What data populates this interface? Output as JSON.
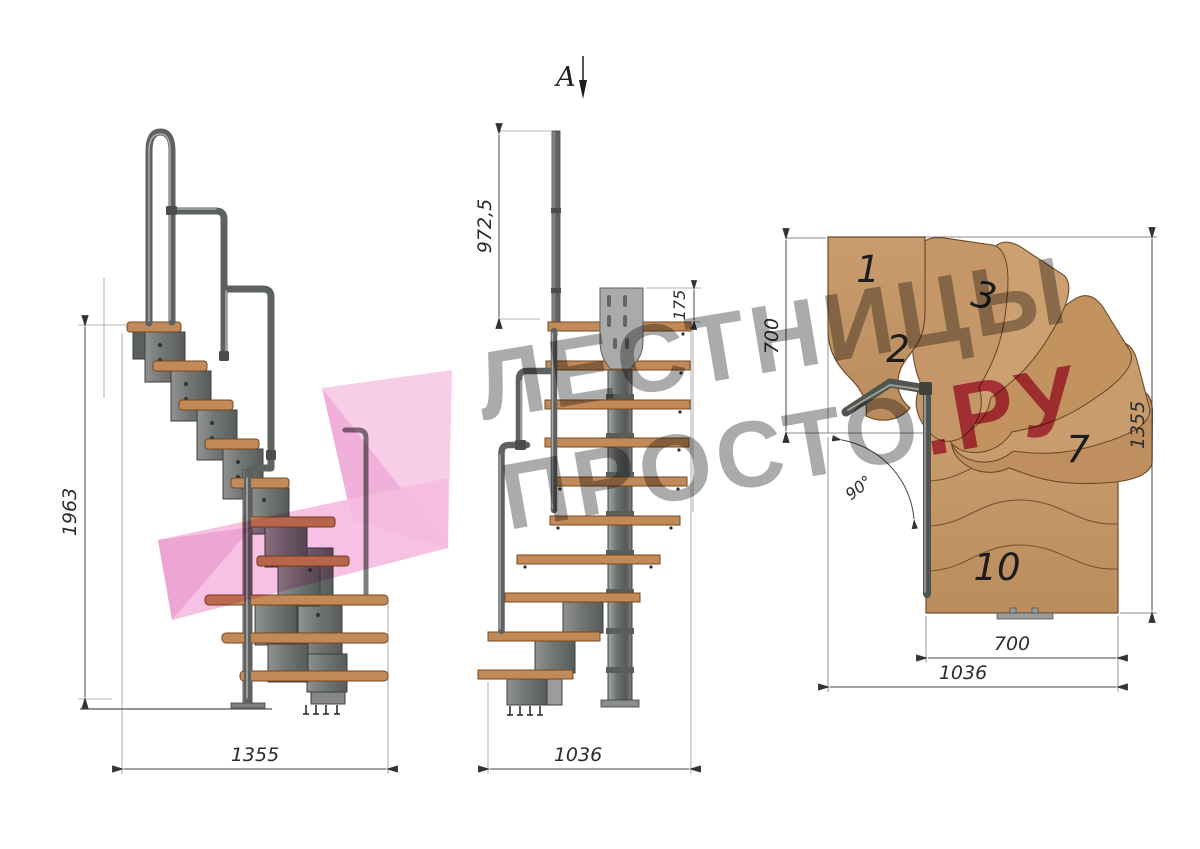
{
  "watermark": {
    "line1": "ЛЕСТНИЦЫ",
    "line2_gray": "ПРОСТО",
    "line2_accent": ".РУ",
    "gray_color": "#ababab",
    "accent_color": "#cf4e79",
    "ribbon_pink": "#f5bce0"
  },
  "section_marker": {
    "label": "А"
  },
  "side_view": {
    "height_label": "1963",
    "width_label": "1355"
  },
  "front_view": {
    "rail_height_label": "972,5",
    "plate_label": "175",
    "width_label": "1036"
  },
  "plan_view": {
    "depth_label": "700",
    "total_label": "1355",
    "tread_width_label": "700",
    "width_label": "1036",
    "angle_label": "90°",
    "tread_numbers": [
      "1",
      "2",
      "3",
      "7",
      "10"
    ]
  },
  "colors": {
    "wood": "#c79a6c",
    "wood_edge": "#6e4a28",
    "metal": "#6f7372",
    "metal_dark": "#3c3f3e",
    "dimension_line": "#444444"
  }
}
